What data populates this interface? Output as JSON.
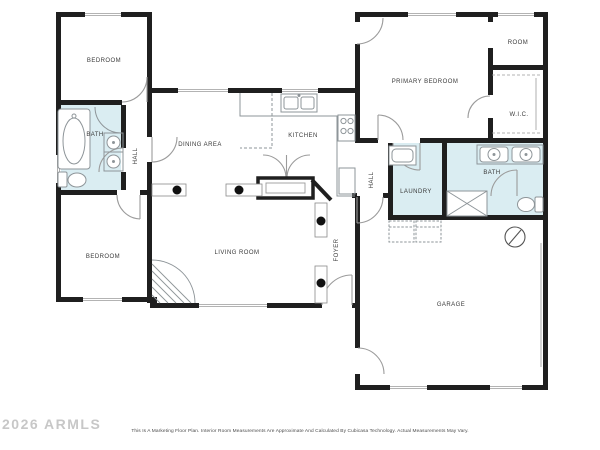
{
  "document": {
    "type": "floor-plan",
    "watermark": "2026 ARMLS",
    "disclaimer": "This Is A Marketing Floor Plan. Interior Room Measurements Are Approximate And Calculated By Cubicasa Technology. Actual Measurements May Vary."
  },
  "colors": {
    "walls": "#1f1f1f",
    "wet_rooms": "#daedf2",
    "fixture_lines": "#8e9599",
    "door_arcs": "#9b9b9b",
    "label_text": "#3a3a3a",
    "watermark": "#c7c7c7",
    "disclaimer_text": "#4a4a4a",
    "background": "#ffffff"
  },
  "rooms": [
    {
      "id": "bedroom-top-left",
      "label": "BEDROOM"
    },
    {
      "id": "bath-left",
      "label": "BATH"
    },
    {
      "id": "hall-left",
      "label": "HALL"
    },
    {
      "id": "bedroom-bottom-left",
      "label": "BEDROOM"
    },
    {
      "id": "dining-area",
      "label": "DINING AREA"
    },
    {
      "id": "kitchen",
      "label": "KITCHEN"
    },
    {
      "id": "living-room",
      "label": "LIVING ROOM"
    },
    {
      "id": "foyer",
      "label": "FOYER"
    },
    {
      "id": "primary-bedroom",
      "label": "PRIMARY BEDROOM"
    },
    {
      "id": "room",
      "label": "ROOM"
    },
    {
      "id": "walk-in-closet",
      "label": "W.I.C."
    },
    {
      "id": "hall-right",
      "label": "HALL"
    },
    {
      "id": "laundry",
      "label": "LAUNDRY"
    },
    {
      "id": "bath-right",
      "label": "BATH"
    },
    {
      "id": "garage",
      "label": "GARAGE"
    }
  ],
  "fixtures": [
    "bathtub",
    "toilet",
    "round-sink",
    "corner-shower",
    "double-vanity",
    "shower-pan",
    "utility-sink",
    "washer",
    "dryer",
    "water-heater",
    "kitchen-sink",
    "stove",
    "refrigerator",
    "pantry-double-doors",
    "closet-rods",
    "columns",
    "corner-fireplace",
    "windows",
    "garage-doors"
  ]
}
